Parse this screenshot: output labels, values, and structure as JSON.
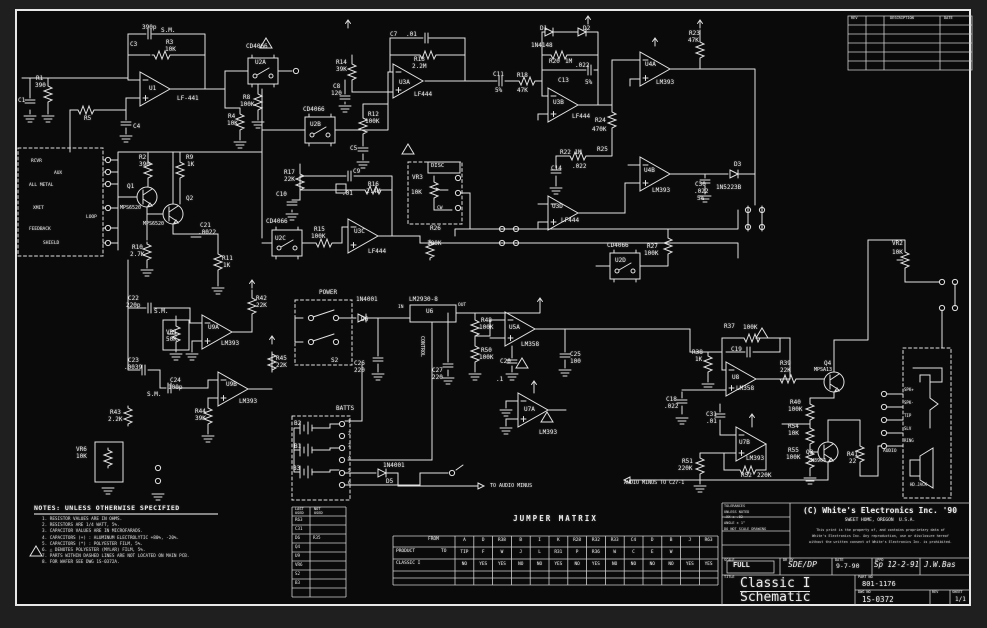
{
  "colors": {
    "background": "#1f1f1f",
    "paper": "#080808",
    "ink": "#e6e6e6"
  },
  "title_block": {
    "copyright": "(C) White's Electronics Inc. '90",
    "address": "SWEET HOME, OREGON  U.S.A.",
    "legal1": "This print is the property of, and contains proprietary data of",
    "legal2": "White's Electronics Inc. Any reproduction, use or disclosure hereof",
    "legal3": "without the written consent of White's Electronics Inc. is prohibited.",
    "tol_lines": [
      "TOLERANCES",
      "UNLESS NOTED",
      ".XX ± .02",
      "ANGLE ± 1°",
      "DO NOT SCALE DRAWING"
    ],
    "scale": "FULL",
    "scale_written": "SDE/DP",
    "date": "9-7-90",
    "appd": "Sp 12-2-91",
    "appd2": "J.W.Bas",
    "title1": "Classic I",
    "title2": "Schematic",
    "part_no": "801-1176",
    "dwg_no": "1S-0372",
    "sheet": "1/1"
  },
  "notes": {
    "heading": "NOTES: UNLESS OTHERWISE SPECIFIED",
    "items": [
      "1. RESISTOR VALUES ARE IN OHMS.",
      "2. RESISTORS ARE 1/4 WATT, 5%.",
      "3. CAPACITOR VALUES ARE IN MICROFARADS.",
      "4. CAPACITORS (+) : ALUMINUM ELECTROLYTIC +80%, -20%.",
      "5. CAPACITORS (*) : POLYESTER FILM, 5%.",
      "6. △ DENOTES POLYESTER (MYLAR) FILM, 5%.",
      "7. PARTS WITHIN DASHED LINES ARE NOT LOCATED ON MAIN PCB.",
      "8. FOR WAFER SEE DWG 1S-0372A."
    ]
  },
  "last_used": {
    "left_header": "LAST USED",
    "right_header": "NOT USED",
    "left": [
      "R63",
      "C31",
      "D6",
      "Q4",
      "U9",
      "VR6",
      "S2",
      "B3"
    ],
    "right": [
      "",
      "",
      "R35",
      "",
      "",
      "",
      "",
      ""
    ]
  },
  "jumper_matrix": {
    "title": "JUMPER MATRIX",
    "from_label": "FROM",
    "to_label": "TO",
    "product_label": "PRODUCT",
    "classic_label": "CLASSIC I",
    "from": [
      "A",
      "D",
      "R38",
      "B",
      "I",
      "K",
      "R28",
      "R32",
      "R33",
      "C4",
      "D",
      "B",
      "J",
      "R63"
    ],
    "to": [
      "TIP",
      "F",
      "W",
      "J",
      "L",
      "R31",
      "P",
      "R36",
      "W",
      "C",
      "E",
      "W",
      "",
      ""
    ],
    "classic": [
      "NO",
      "YES",
      "YES",
      "NO",
      "NO",
      "YES",
      "NO",
      "YES",
      "NO",
      "NO",
      "NO",
      "NO",
      "YES",
      "YES"
    ]
  },
  "labels": [
    {
      "t": "390p",
      "x": 142,
      "y": 25
    },
    {
      "t": "S.M.",
      "x": 161,
      "y": 28
    },
    {
      "t": "C3",
      "x": 130,
      "y": 42
    },
    {
      "t": "R3",
      "x": 166,
      "y": 40
    },
    {
      "t": "10K",
      "x": 165,
      "y": 47
    },
    {
      "t": "U1",
      "x": 149,
      "y": 86
    },
    {
      "t": "LF-441",
      "x": 177,
      "y": 96
    },
    {
      "t": "R1",
      "x": 36,
      "y": 76
    },
    {
      "t": "390",
      "x": 35,
      "y": 83
    },
    {
      "t": "C1",
      "x": 18,
      "y": 98
    },
    {
      "t": "R5",
      "x": 84,
      "y": 116
    },
    {
      "t": "C4",
      "x": 133,
      "y": 124
    },
    {
      "t": "RCVR",
      "x": 31,
      "y": 160,
      "s": 4.5
    },
    {
      "t": "AUX",
      "x": 54,
      "y": 172,
      "s": 4.5
    },
    {
      "t": "ALL METAL",
      "x": 29,
      "y": 184,
      "s": 4.5
    },
    {
      "t": "XMIT",
      "x": 33,
      "y": 207,
      "s": 4.5
    },
    {
      "t": "FEEDBACK",
      "x": 29,
      "y": 228,
      "s": 4.5
    },
    {
      "t": "SHIELD",
      "x": 43,
      "y": 242,
      "s": 4.5
    },
    {
      "t": "LOOP",
      "x": 86,
      "y": 216,
      "s": 4.5
    },
    {
      "t": "Q1",
      "x": 127,
      "y": 184
    },
    {
      "t": "MPS6520",
      "x": 120,
      "y": 206,
      "s": 5
    },
    {
      "t": "Q2",
      "x": 186,
      "y": 196
    },
    {
      "t": "MPS6520",
      "x": 143,
      "y": 222,
      "s": 5
    },
    {
      "t": "R2",
      "x": 139,
      "y": 155
    },
    {
      "t": "390",
      "x": 139,
      "y": 162
    },
    {
      "t": "R9",
      "x": 186,
      "y": 155
    },
    {
      "t": "1K",
      "x": 187,
      "y": 162
    },
    {
      "t": "C21",
      "x": 200,
      "y": 223
    },
    {
      "t": ".0022",
      "x": 198,
      "y": 230
    },
    {
      "t": "R10",
      "x": 132,
      "y": 245
    },
    {
      "t": "2.7K",
      "x": 130,
      "y": 252
    },
    {
      "t": "R11",
      "x": 222,
      "y": 256
    },
    {
      "t": "1K",
      "x": 223,
      "y": 263
    },
    {
      "t": "CD4066",
      "x": 246,
      "y": 44
    },
    {
      "t": "U2A",
      "x": 255,
      "y": 60
    },
    {
      "t": "R8",
      "x": 243,
      "y": 95
    },
    {
      "t": "100K",
      "x": 240,
      "y": 102
    },
    {
      "t": "R4",
      "x": 228,
      "y": 114
    },
    {
      "t": "10K",
      "x": 227,
      "y": 121
    },
    {
      "t": "CD4066",
      "x": 303,
      "y": 107
    },
    {
      "t": "U2B",
      "x": 310,
      "y": 122
    },
    {
      "t": "R12",
      "x": 368,
      "y": 112
    },
    {
      "t": "100K",
      "x": 365,
      "y": 119
    },
    {
      "t": "C5",
      "x": 350,
      "y": 146
    },
    {
      "t": "R14",
      "x": 336,
      "y": 60
    },
    {
      "t": "39K",
      "x": 336,
      "y": 67
    },
    {
      "t": "C8",
      "x": 333,
      "y": 84
    },
    {
      "t": "120",
      "x": 331,
      "y": 91
    },
    {
      "t": "C7",
      "x": 390,
      "y": 32
    },
    {
      "t": ".01",
      "x": 406,
      "y": 32
    },
    {
      "t": "R13",
      "x": 414,
      "y": 57
    },
    {
      "t": "2.2M",
      "x": 412,
      "y": 64
    },
    {
      "t": "U3A",
      "x": 399,
      "y": 80
    },
    {
      "t": "LF444",
      "x": 414,
      "y": 92
    },
    {
      "t": "C11",
      "x": 493,
      "y": 72
    },
    {
      "t": "5%",
      "x": 495,
      "y": 88
    },
    {
      "t": "R18",
      "x": 517,
      "y": 73
    },
    {
      "t": "47K",
      "x": 517,
      "y": 88
    },
    {
      "t": "D1",
      "x": 540,
      "y": 26
    },
    {
      "t": "1N4148",
      "x": 531,
      "y": 43
    },
    {
      "t": "D2",
      "x": 583,
      "y": 26
    },
    {
      "t": "R20",
      "x": 549,
      "y": 59
    },
    {
      "t": "1M",
      "x": 565,
      "y": 59
    },
    {
      "t": ".022",
      "x": 575,
      "y": 63
    },
    {
      "t": "C13",
      "x": 558,
      "y": 78
    },
    {
      "t": "5%",
      "x": 585,
      "y": 80
    },
    {
      "t": "U3B",
      "x": 553,
      "y": 100
    },
    {
      "t": "LF444",
      "x": 572,
      "y": 114
    },
    {
      "t": "R24",
      "x": 595,
      "y": 118
    },
    {
      "t": "470K",
      "x": 592,
      "y": 127
    },
    {
      "t": "R22 1M",
      "x": 560,
      "y": 150
    },
    {
      "t": "R25",
      "x": 597,
      "y": 147
    },
    {
      "t": "C14",
      "x": 551,
      "y": 166
    },
    {
      "t": ".022",
      "x": 572,
      "y": 164
    },
    {
      "t": "U3D",
      "x": 552,
      "y": 204
    },
    {
      "t": "LF444",
      "x": 561,
      "y": 218
    },
    {
      "t": "R23",
      "x": 689,
      "y": 31
    },
    {
      "t": "47K",
      "x": 688,
      "y": 38
    },
    {
      "t": "U4A",
      "x": 645,
      "y": 62
    },
    {
      "t": "LM393",
      "x": 656,
      "y": 80
    },
    {
      "t": "U4B",
      "x": 644,
      "y": 168
    },
    {
      "t": "LM393",
      "x": 652,
      "y": 188
    },
    {
      "t": "D3",
      "x": 734,
      "y": 162
    },
    {
      "t": "1N5223B",
      "x": 716,
      "y": 185
    },
    {
      "t": "C30",
      "x": 695,
      "y": 182
    },
    {
      "t": ".022",
      "x": 694,
      "y": 189
    },
    {
      "t": "5%",
      "x": 697,
      "y": 196
    },
    {
      "t": "CD4066",
      "x": 607,
      "y": 243
    },
    {
      "t": "U2D",
      "x": 615,
      "y": 258
    },
    {
      "t": "R27",
      "x": 647,
      "y": 244
    },
    {
      "t": "100K",
      "x": 644,
      "y": 251
    },
    {
      "t": "R17",
      "x": 284,
      "y": 170
    },
    {
      "t": "22K",
      "x": 284,
      "y": 177
    },
    {
      "t": "C10",
      "x": 276,
      "y": 192
    },
    {
      "t": "C9",
      "x": 353,
      "y": 169
    },
    {
      "t": ".01",
      "x": 342,
      "y": 191
    },
    {
      "t": "R16",
      "x": 368,
      "y": 182
    },
    {
      "t": "2.4M",
      "x": 366,
      "y": 189
    },
    {
      "t": "U3C",
      "x": 354,
      "y": 229
    },
    {
      "t": "LF444",
      "x": 368,
      "y": 249
    },
    {
      "t": "R15",
      "x": 314,
      "y": 227
    },
    {
      "t": "100K",
      "x": 311,
      "y": 234
    },
    {
      "t": "R26",
      "x": 430,
      "y": 226
    },
    {
      "t": "100K",
      "x": 427,
      "y": 241
    },
    {
      "t": "CD4066",
      "x": 266,
      "y": 219
    },
    {
      "t": "U2C",
      "x": 275,
      "y": 236
    },
    {
      "t": "DISC",
      "x": 431,
      "y": 164,
      "s": 5.5
    },
    {
      "t": "VR3",
      "x": 412,
      "y": 175
    },
    {
      "t": "10K",
      "x": 411,
      "y": 190
    },
    {
      "t": "CW",
      "x": 437,
      "y": 207,
      "s": 4.5
    },
    {
      "t": "C22",
      "x": 128,
      "y": 296
    },
    {
      "t": "220p",
      "x": 126,
      "y": 303
    },
    {
      "t": "S.M.",
      "x": 154,
      "y": 309
    },
    {
      "t": "VR1",
      "x": 166,
      "y": 330
    },
    {
      "t": "50K",
      "x": 166,
      "y": 337
    },
    {
      "t": "U9A",
      "x": 208,
      "y": 325
    },
    {
      "t": "LM393",
      "x": 221,
      "y": 341
    },
    {
      "t": "R42",
      "x": 256,
      "y": 296
    },
    {
      "t": "22K",
      "x": 256,
      "y": 303
    },
    {
      "t": "R45",
      "x": 276,
      "y": 356
    },
    {
      "t": "22K",
      "x": 276,
      "y": 363
    },
    {
      "t": "C23",
      "x": 128,
      "y": 358
    },
    {
      "t": ".0039",
      "x": 124,
      "y": 365
    },
    {
      "t": "C24",
      "x": 170,
      "y": 378
    },
    {
      "t": "100p",
      "x": 168,
      "y": 385
    },
    {
      "t": "S.M.",
      "x": 147,
      "y": 392
    },
    {
      "t": "U9B",
      "x": 226,
      "y": 382
    },
    {
      "t": "LM393",
      "x": 239,
      "y": 399
    },
    {
      "t": "R44",
      "x": 195,
      "y": 409
    },
    {
      "t": "39K",
      "x": 195,
      "y": 416
    },
    {
      "t": "R43",
      "x": 110,
      "y": 410
    },
    {
      "t": "2.2K",
      "x": 108,
      "y": 417
    },
    {
      "t": "VR6",
      "x": 76,
      "y": 447
    },
    {
      "t": "10K",
      "x": 76,
      "y": 454
    },
    {
      "t": "POWER",
      "x": 319,
      "y": 290
    },
    {
      "t": "1N4001",
      "x": 356,
      "y": 297
    },
    {
      "t": "D6",
      "x": 361,
      "y": 317
    },
    {
      "t": "LM2930-8",
      "x": 409,
      "y": 297
    },
    {
      "t": "U6",
      "x": 426,
      "y": 309
    },
    {
      "t": "IN",
      "x": 398,
      "y": 306,
      "s": 4.5
    },
    {
      "t": "OUT",
      "x": 458,
      "y": 304,
      "s": 4.5
    },
    {
      "t": "CONTROL",
      "x": 424,
      "y": 336,
      "r": 90,
      "s": 5
    },
    {
      "t": "S2",
      "x": 331,
      "y": 358
    },
    {
      "t": "C26",
      "x": 354,
      "y": 361
    },
    {
      "t": "220",
      "x": 354,
      "y": 368
    },
    {
      "t": "C27",
      "x": 432,
      "y": 368
    },
    {
      "t": "220",
      "x": 432,
      "y": 375
    },
    {
      "t": "R48",
      "x": 481,
      "y": 318
    },
    {
      "t": "100K",
      "x": 479,
      "y": 325
    },
    {
      "t": "R50",
      "x": 481,
      "y": 348
    },
    {
      "t": "100K",
      "x": 479,
      "y": 355
    },
    {
      "t": "BATTS",
      "x": 336,
      "y": 406
    },
    {
      "t": "B2",
      "x": 294,
      "y": 421
    },
    {
      "t": "B1",
      "x": 294,
      "y": 444
    },
    {
      "t": "B3",
      "x": 293,
      "y": 466
    },
    {
      "t": "1",
      "x": 348,
      "y": 421,
      "s": 4.5
    },
    {
      "t": "2",
      "x": 348,
      "y": 433,
      "s": 4.5
    },
    {
      "t": "3",
      "x": 348,
      "y": 445,
      "s": 4.5
    },
    {
      "t": "4",
      "x": 348,
      "y": 457,
      "s": 4.5
    },
    {
      "t": "5",
      "x": 348,
      "y": 470,
      "s": 4.5
    },
    {
      "t": "6",
      "x": 348,
      "y": 482,
      "s": 4.5
    },
    {
      "t": "1N4001",
      "x": 383,
      "y": 463
    },
    {
      "t": "D5",
      "x": 386,
      "y": 479
    },
    {
      "t": "TO AUDIO MINUS",
      "x": 490,
      "y": 484,
      "s": 5
    },
    {
      "t": "U5A",
      "x": 509,
      "y": 325
    },
    {
      "t": "LM358",
      "x": 521,
      "y": 342
    },
    {
      "t": "C20",
      "x": 500,
      "y": 359
    },
    {
      "t": ".1",
      "x": 496,
      "y": 377
    },
    {
      "t": "C25",
      "x": 570,
      "y": 352
    },
    {
      "t": "100",
      "x": 570,
      "y": 359
    },
    {
      "t": "U7A",
      "x": 524,
      "y": 407
    },
    {
      "t": "LM393",
      "x": 539,
      "y": 430
    },
    {
      "t": "R37",
      "x": 724,
      "y": 324
    },
    {
      "t": "100K",
      "x": 743,
      "y": 325
    },
    {
      "t": "C19",
      "x": 731,
      "y": 347
    },
    {
      "t": "R38",
      "x": 692,
      "y": 350
    },
    {
      "t": "1K",
      "x": 695,
      "y": 357
    },
    {
      "t": "U8",
      "x": 732,
      "y": 375
    },
    {
      "t": "LM358",
      "x": 736,
      "y": 386
    },
    {
      "t": "R39",
      "x": 780,
      "y": 361
    },
    {
      "t": "22K",
      "x": 780,
      "y": 368
    },
    {
      "t": "Q4",
      "x": 824,
      "y": 361
    },
    {
      "t": "MPSA13",
      "x": 814,
      "y": 368,
      "s": 5
    },
    {
      "t": "R40",
      "x": 790,
      "y": 400
    },
    {
      "t": "100K",
      "x": 788,
      "y": 407
    },
    {
      "t": "R54",
      "x": 788,
      "y": 424
    },
    {
      "t": "10K",
      "x": 788,
      "y": 431
    },
    {
      "t": "R55",
      "x": 788,
      "y": 448
    },
    {
      "t": "100K",
      "x": 786,
      "y": 455
    },
    {
      "t": "C18",
      "x": 666,
      "y": 397
    },
    {
      "t": ".022",
      "x": 664,
      "y": 404
    },
    {
      "t": "C31",
      "x": 706,
      "y": 412
    },
    {
      "t": ".01",
      "x": 706,
      "y": 419
    },
    {
      "t": "U7B",
      "x": 739,
      "y": 440
    },
    {
      "t": "LM393",
      "x": 746,
      "y": 456
    },
    {
      "t": "R51",
      "x": 682,
      "y": 459
    },
    {
      "t": "220K",
      "x": 678,
      "y": 466
    },
    {
      "t": "R52",
      "x": 741,
      "y": 473
    },
    {
      "t": "220K",
      "x": 757,
      "y": 473
    },
    {
      "t": "Q3",
      "x": 806,
      "y": 450
    },
    {
      "t": "2N3904",
      "x": 808,
      "y": 459,
      "s": 5
    },
    {
      "t": "R41",
      "x": 847,
      "y": 452
    },
    {
      "t": "22",
      "x": 849,
      "y": 459
    },
    {
      "t": "AUDIO MINUS TO C27-1",
      "x": 624,
      "y": 481,
      "s": 5
    },
    {
      "t": "AUDIO",
      "x": 883,
      "y": 450,
      "s": 4.5
    },
    {
      "t": "VR2",
      "x": 892,
      "y": 241
    },
    {
      "t": "10K",
      "x": 892,
      "y": 250
    },
    {
      "t": "SPK+",
      "x": 904,
      "y": 388,
      "s": 4
    },
    {
      "t": "SPK-",
      "x": 904,
      "y": 401,
      "s": 4
    },
    {
      "t": "TIP",
      "x": 904,
      "y": 414,
      "s": 4
    },
    {
      "t": "SLV",
      "x": 904,
      "y": 427,
      "s": 4
    },
    {
      "t": "RING",
      "x": 904,
      "y": 439,
      "s": 4
    },
    {
      "t": "HD.JACK",
      "x": 910,
      "y": 483,
      "s": 4
    },
    {
      "t": "FROM",
      "x": 428,
      "y": 538,
      "s": 4.5
    },
    {
      "t": "PRODUCT",
      "x": 396,
      "y": 550,
      "s": 4.5
    },
    {
      "t": "TO",
      "x": 441,
      "y": 550,
      "s": 4.5
    },
    {
      "t": "CLASSIC I",
      "x": 396,
      "y": 562,
      "s": 4.5
    },
    {
      "t": "LAST",
      "x": 295,
      "y": 508,
      "s": 3.6
    },
    {
      "t": "USED",
      "x": 295,
      "y": 512,
      "s": 3.6
    },
    {
      "t": "NOT",
      "x": 314,
      "y": 508,
      "s": 3.6
    },
    {
      "t": "USED",
      "x": 314,
      "y": 512,
      "s": 3.6
    },
    {
      "t": "REV",
      "x": 851,
      "y": 17,
      "s": 3.6
    },
    {
      "t": "DESCRIPTION",
      "x": 890,
      "y": 17,
      "s": 3.6
    },
    {
      "t": "DATE",
      "x": 944,
      "y": 17,
      "s": 3.6
    },
    {
      "t": "SCALE",
      "x": 724,
      "y": 559,
      "s": 3.5
    },
    {
      "t": "DR BY",
      "x": 783,
      "y": 559,
      "s": 3.5
    },
    {
      "t": "DATE",
      "x": 835,
      "y": 559,
      "s": 3.5
    },
    {
      "t": "APPD",
      "x": 875,
      "y": 559,
      "s": 3.5
    },
    {
      "t": "TITLE",
      "x": 724,
      "y": 576,
      "s": 3.5
    },
    {
      "t": "PART NO",
      "x": 858,
      "y": 576,
      "s": 3.5
    },
    {
      "t": "DWG NO",
      "x": 858,
      "y": 591,
      "s": 3.5
    },
    {
      "t": "REV",
      "x": 932,
      "y": 591,
      "s": 3.5
    },
    {
      "t": "SHEET",
      "x": 952,
      "y": 591,
      "s": 3.5
    }
  ]
}
